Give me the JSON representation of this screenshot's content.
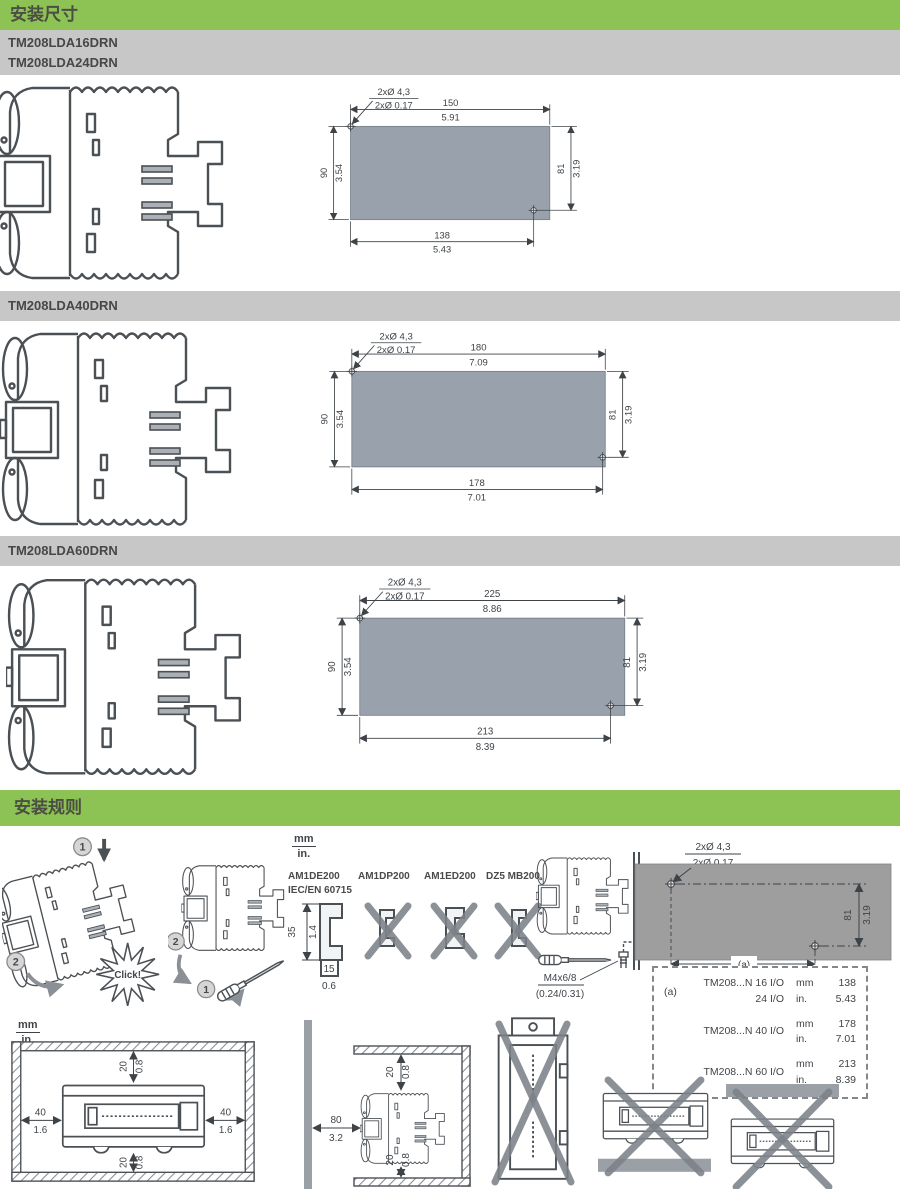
{
  "colors": {
    "header_green": "#8dc254",
    "model_bar_gray": "#c7c7c7",
    "panel_blue_gray": "#99a1ad",
    "panel_gray": "#9e9e9e",
    "line_dark": "#3e4347",
    "cross_gray": "#7c8288"
  },
  "dims": {
    "title": "安装尺寸",
    "sections": [
      {
        "models": [
          "TM208LDA16DRN",
          "TM208LDA24DRN"
        ],
        "hole_mm": "2xØ 4,3",
        "hole_in": "2xØ 0.17",
        "top_mm": "150",
        "top_in": "5.91",
        "left_mm": "90",
        "left_in": "3.54",
        "right_mm": "81",
        "right_in": "3.19",
        "bottom_mm": "138",
        "bottom_in": "5.43"
      },
      {
        "models": [
          "TM208LDA40DRN"
        ],
        "hole_mm": "2xØ 4,3",
        "hole_in": "2xØ 0.17",
        "top_mm": "180",
        "top_in": "7.09",
        "left_mm": "90",
        "left_in": "3.54",
        "right_mm": "81",
        "right_in": "3.19",
        "bottom_mm": "178",
        "bottom_in": "7.01"
      },
      {
        "models": [
          "TM208LDA60DRN"
        ],
        "hole_mm": "2xØ 4,3",
        "hole_in": "2xØ 0.17",
        "top_mm": "225",
        "top_in": "8.86",
        "left_mm": "90",
        "left_in": "3.54",
        "right_mm": "81",
        "right_in": "3.19",
        "bottom_mm": "213",
        "bottom_in": "8.39"
      }
    ]
  },
  "rules": {
    "title": "安装规则",
    "units": {
      "mm": "mm",
      "in": "in."
    },
    "steps": {
      "one": "1",
      "two": "2"
    },
    "click": "Click!",
    "rails": {
      "allowed": {
        "name": "AM1DE200",
        "standard": "IEC/EN 60715",
        "h_mm": "35",
        "h_in": "1.4",
        "w_mm": "15",
        "w_in": "0.6"
      },
      "forbidden": [
        {
          "name": "AM1DP200"
        },
        {
          "name": "AM1ED200"
        },
        {
          "name": "DZ5 MB200"
        }
      ]
    },
    "screw": {
      "size": "M4x6/8",
      "size_in": "(0.24/0.31)"
    },
    "panel": {
      "hole_mm": "2xØ 4,3",
      "hole_in": "2xØ 0.17",
      "right_mm": "81",
      "right_in": "3.19",
      "ref": "(a)"
    },
    "table": {
      "ref": "(a)",
      "rows": [
        {
          "model1": "TM208...N 16 I/O",
          "model2": "24 I/O",
          "u1": "mm",
          "v1": "138",
          "u2": "in.",
          "v2": "5.43"
        },
        {
          "model1": "TM208...N 40 I/O",
          "u1": "mm",
          "v1": "178",
          "u2": "in.",
          "v2": "7.01"
        },
        {
          "model1": "TM208...N 60 I/O",
          "u1": "mm",
          "v1": "213",
          "u2": "in.",
          "v2": "8.39"
        }
      ]
    },
    "clear": {
      "gap_mm": "20",
      "gap_in": "0.8",
      "side_mm": "40",
      "side_in": "1.6",
      "front_mm": "80",
      "front_in": "3.2"
    }
  }
}
